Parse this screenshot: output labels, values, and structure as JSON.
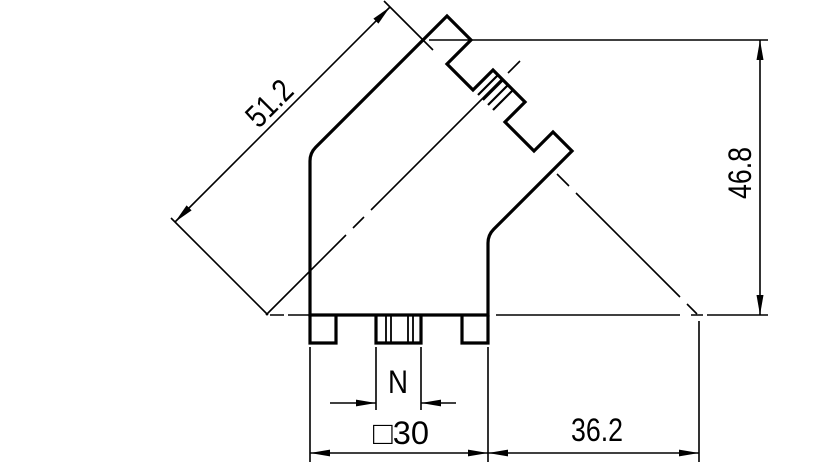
{
  "drawing": {
    "dimensions": {
      "diagonal_axis_length": "51.2",
      "overall_height": "46.8",
      "body_width": "□30",
      "face_plane_offset": "36.2",
      "notch_width": "N"
    },
    "colors": {
      "line": "#000000",
      "background": "#ffffff"
    }
  }
}
